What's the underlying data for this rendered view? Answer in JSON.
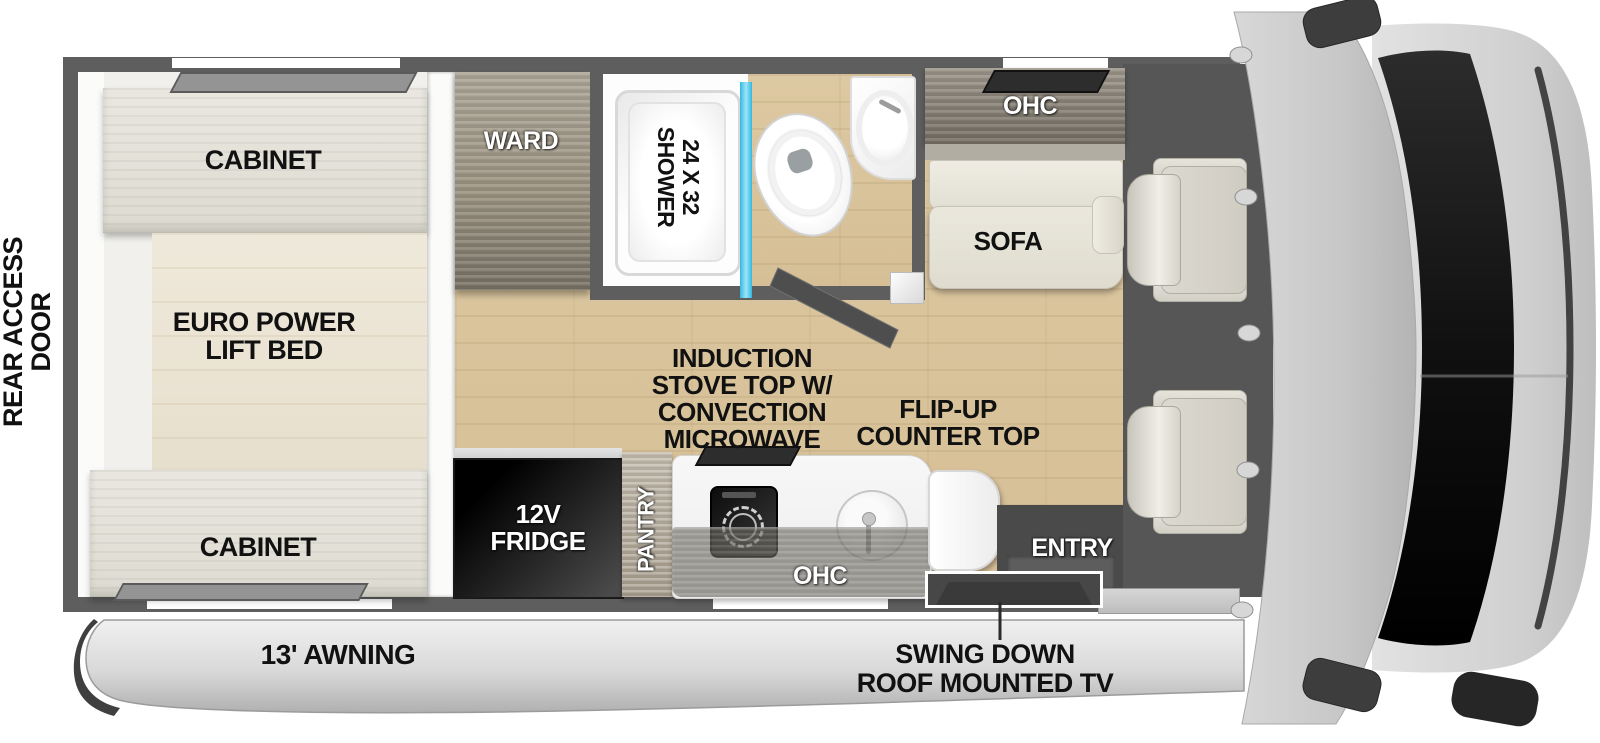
{
  "labels": {
    "rear_access_door": [
      "REAR ACCESS",
      "DOOR"
    ],
    "bedroom": {
      "cabinet_top": "CABINET",
      "bed": [
        "EURO POWER",
        "LIFT BED"
      ],
      "cabinet_bottom": "CABINET"
    },
    "wardrobe": "WARD",
    "bathroom": {
      "shower": [
        "24 X 32",
        "SHOWER"
      ]
    },
    "lounge": {
      "ohc": "OHC",
      "sofa": "SOFA"
    },
    "kitchen": {
      "stove": [
        "INDUCTION",
        "STOVE TOP W/",
        "CONVECTION",
        "MICROWAVE"
      ],
      "flip_up": [
        "FLIP-UP",
        "COUNTER TOP"
      ],
      "fridge": [
        "12V",
        "FRIDGE"
      ],
      "pantry": "PANTRY",
      "ohc": "OHC"
    },
    "entry": "ENTRY",
    "awning": "13' AWNING",
    "tv": [
      "SWING DOWN",
      "ROOF MOUNTED TV"
    ]
  },
  "colors": {
    "wall": "#5e5e5e",
    "wood_floor": "#d9c39c",
    "bed": "#ebe4d6",
    "cabinet": "#e3e1d8",
    "wardrobe_wood": "#968e82",
    "shower_glass": "#3cc3e8",
    "fridge": "#0d0d0d",
    "sofa": "#e8e5da",
    "cab_floor": "#565656",
    "windshield": "#141414",
    "vehicle_body": "#c9c9c9",
    "awning": "#d8d8d8",
    "label_black": "#111111",
    "label_white": "#ffffff"
  }
}
